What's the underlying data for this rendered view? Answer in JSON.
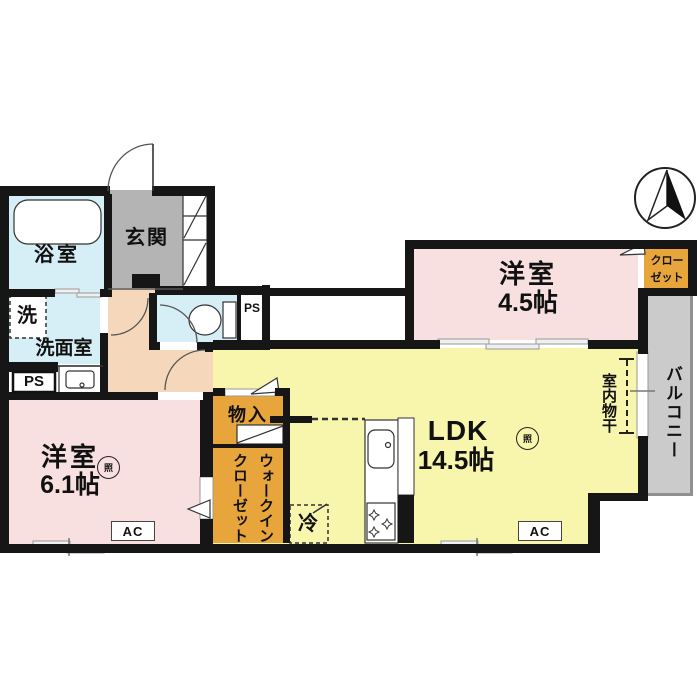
{
  "plan": {
    "rooms": {
      "bathroom": {
        "label": "浴室"
      },
      "entrance": {
        "label": "玄関"
      },
      "washer": {
        "label": "洗"
      },
      "washroom": {
        "label": "洗面室"
      },
      "pipe_space_left": {
        "label": "PS"
      },
      "pipe_space_toilet": {
        "label": "PS"
      },
      "bedroom_61": {
        "label": "洋室",
        "area": "6.1帖"
      },
      "bedroom_45": {
        "label": "洋室",
        "area": "4.5帖"
      },
      "ldk": {
        "label": "LDK",
        "area": "14.5帖"
      },
      "storage": {
        "label": "物入"
      },
      "walk_in_closet": {
        "label": "ウォークインクローゼット"
      },
      "closet": {
        "label": "クローゼット"
      },
      "refrigerator": {
        "label": "冷"
      },
      "balcony": {
        "label": "バルコニー"
      },
      "indoor_drying": {
        "label": "室内物干"
      }
    },
    "markers": {
      "ac": "AC",
      "light": "照"
    },
    "colors": {
      "wall": "#161616",
      "water_blue": "#d6eef5",
      "entrance_gray": "#b4b4b4",
      "hallway_peach": "#f5d8bb",
      "room_pink": "#f8e0e0",
      "ldk_yellow": "#f8f5ad",
      "storage_orange": "#e8a53c",
      "balcony_gray": "#cbcbcb"
    }
  }
}
